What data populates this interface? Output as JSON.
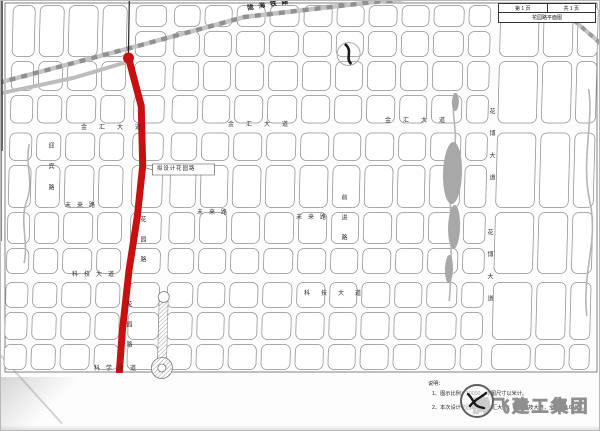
{
  "titleblock": {
    "page_no": "第 1 页",
    "page_total": "共 1 页",
    "drawing_title": "花园路平面图"
  },
  "map": {
    "labels": {
      "jinhui": "金汇大道",
      "weilai": "未来路",
      "keji": "科技大道",
      "kexue": "科学大道",
      "huayuan": "花园路",
      "huabo": "花博大道",
      "yingbin": "迎宾路",
      "qianjin": "前进路",
      "railway": "陇海铁路",
      "callout": "拟设计花园路"
    }
  },
  "notes": {
    "heading": "说明：",
    "line1": "1、图示比例：10000，本图尺寸以米计。",
    "line2": "2、本次设计花园路北起金汇大道，南至科技大道，全长约2.6公里。"
  },
  "watermark": {
    "company": "腾飞建工集团"
  },
  "colors": {
    "route_red": "#c81010",
    "road_gray": "#b3b3b3",
    "block_line": "#8f8f8f"
  }
}
